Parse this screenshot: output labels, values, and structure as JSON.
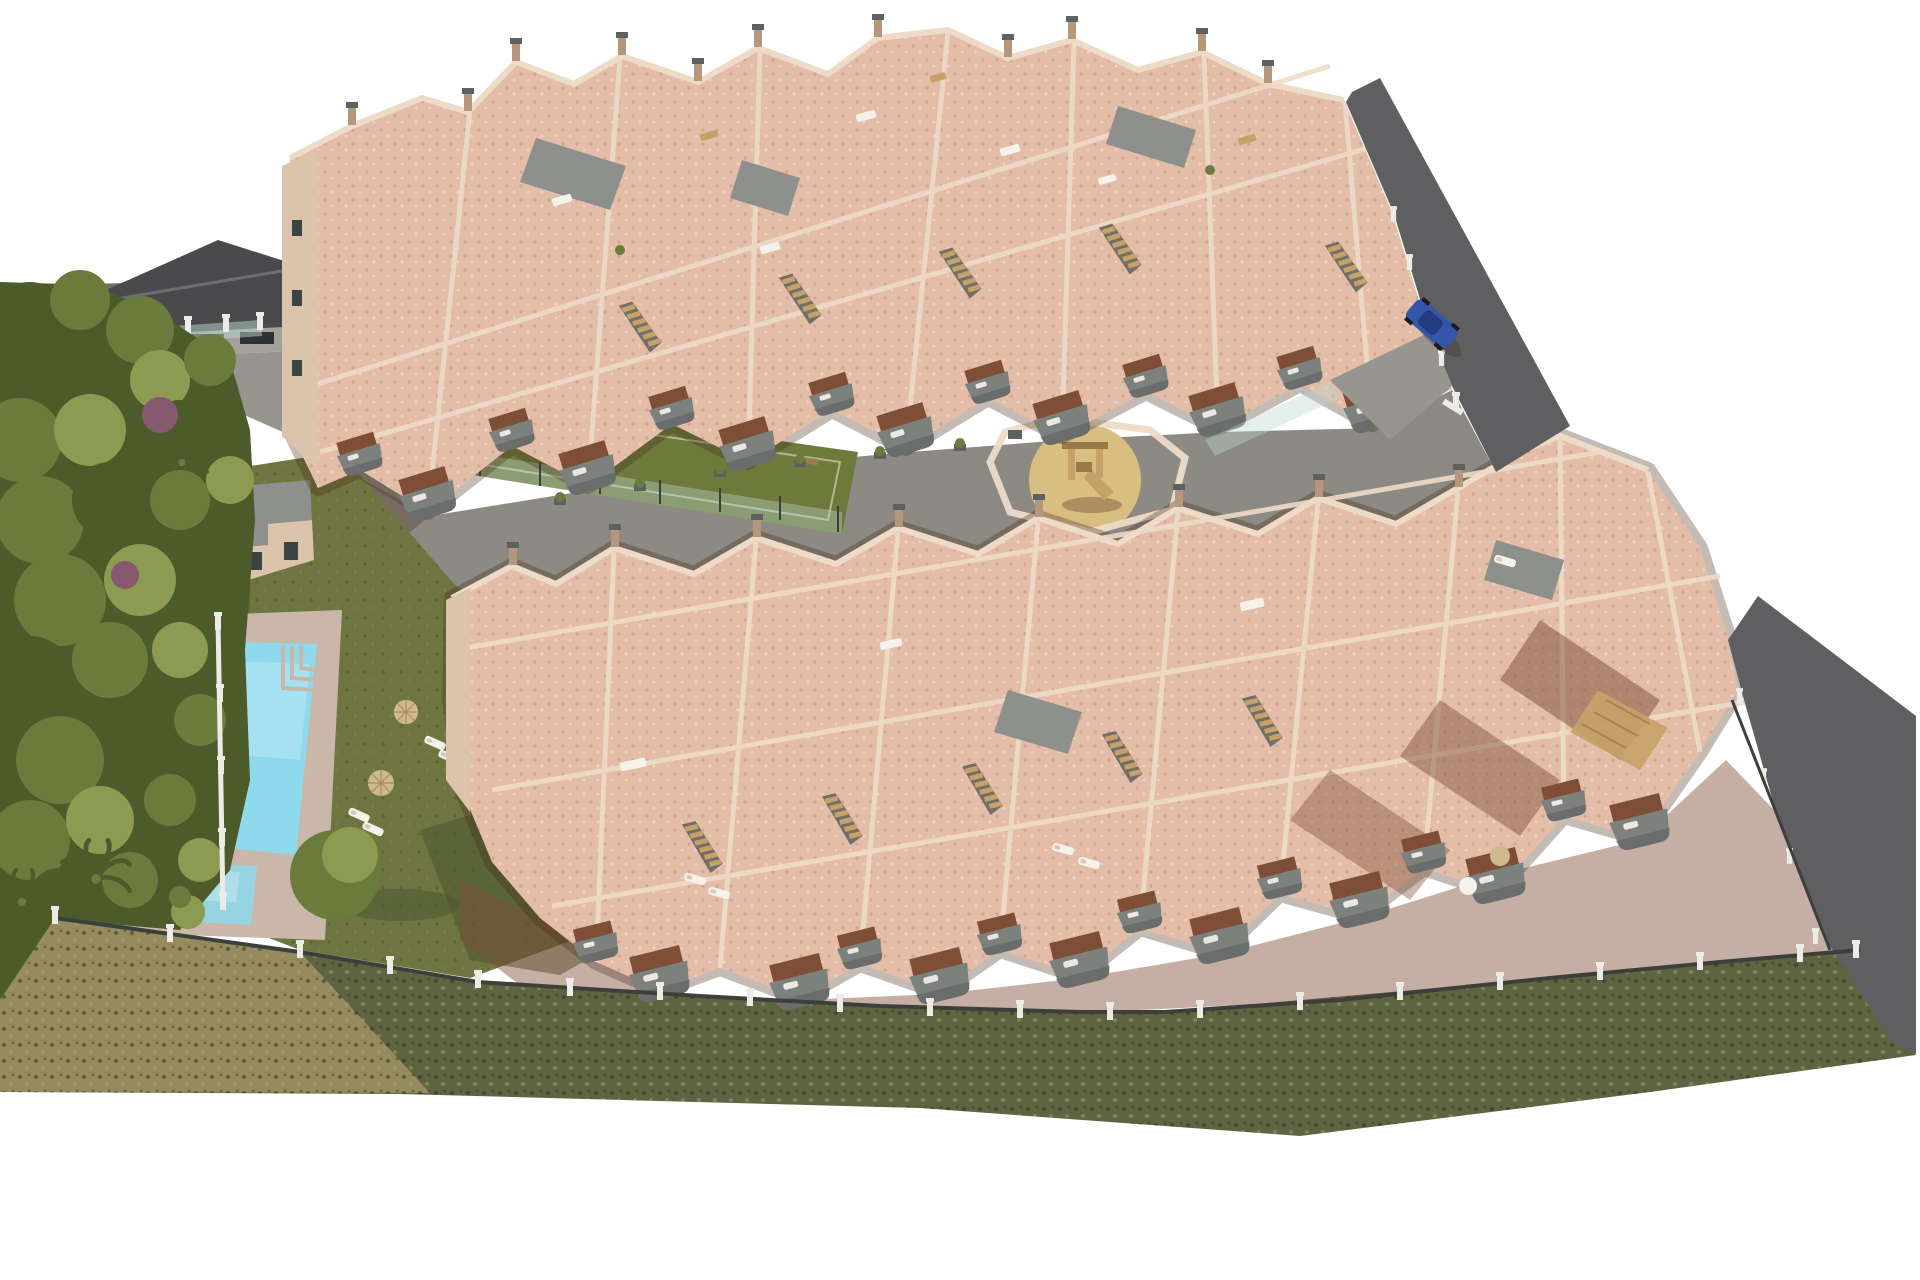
{
  "meta": {
    "title": "Aerial 3D architectural rendering of a new-build apartment complex with communal pool, gardens, playground and sports pitch",
    "image_kind": "computer-generated real-estate visualization",
    "view": "high oblique aerial view on white background"
  },
  "palette": {
    "page_bg": "#ffffff",
    "wall_light": "#eddbc7",
    "wall_mid": "#dcc3ab",
    "wall_shadow": "#b4977d",
    "terrace_tile": "#e3bda8",
    "terracotta": "#7e4e37",
    "balcony_gray": "#7d817e",
    "balcony_dark": "#5d615f",
    "panel_gray": "#8e908d",
    "road_dark": "#5f5f61",
    "paving_gray": "#98958f",
    "plaza_gray": "#8d8a84",
    "lawn_green": "#6f7540",
    "lawn_dark": "#4a552f",
    "pitch_green": "#6e7a3b",
    "tree_green": "#6b7b3c",
    "tree_dark": "#4b5b2a",
    "tree_light": "#8c9a52",
    "shrub_purple": "#86596f",
    "scrub_olive": "#5e6442",
    "scrub_tan": "#a99868",
    "pool_water": "#8ed9ec",
    "pool_light": "#c7eef7",
    "pool_deck": "#c9b7a9",
    "sand_yellow": "#d9be82",
    "wood": "#c7a268",
    "wood_dark": "#9a7a4a",
    "car_blue": "#3456aa",
    "car_dark": "#22387a",
    "fence_white": "#edebe5",
    "fence_dark": "#3c403b",
    "glass_teal": "#bcd8cf",
    "white_obj": "#f5f2eb",
    "parasol_straw": "#cdb98c",
    "neighbor_roof": "#4a4a4c",
    "neighbor_wall": "#a3a09a",
    "shadow_tint": "rgba(70,45,25,0.32)"
  },
  "scene": {
    "site": "irregular pentagonal parcel seen from above, surrounded by white emptiness",
    "buildings": {
      "upper_row": "long diagonal row of cream apartment blocks with pink tiled roof terraces, chimneys, gray solar panels, outdoor stairs and gray-fronted balconies facing lower-left",
      "lower_row": "second larger diagonal row of the same apartment type with stepped roof terraces, pergola, loungers and balconies facing the lower fence",
      "pool_house": "small cream outbuilding with flat gray roof beside the lawn",
      "neighbor_building": "adjacent existing building with dark pitched roof at top-left"
    },
    "amenities": {
      "main_pool": "rectangular turquoise pool with corner steps and ladder on a pale deck",
      "kids_pool": "small rectangular splash pool below the main pool",
      "sun_loungers_poolside": 4,
      "straw_parasols_poolside": 2,
      "lawn": "large olive-green communal lawn around the pool",
      "sports_pitch": "green multi-sport pitch with glass fence, white goal and bench between the building rows",
      "playground": "round sand area with wooden climbing frame and slide inside low cream walls"
    },
    "landscape": {
      "tree_band": "dense green tree canopy along the whole left edge with purple flowering shrubs",
      "palm_trees": 3,
      "round_clipped_tree": "layered round tree beside the kids pool",
      "scrub_strip": "dry olive-brown scrubland strip along the bottom boundary",
      "perimeter_fence": "white-posted fence with dark mesh panels along the lower boundary"
    },
    "circulation": {
      "access_road_upper": "dark asphalt road running along the upper-right edge of the complex",
      "access_road_right": "dark asphalt road wrapping down the right edge",
      "driveway_top_left": "gray paved driveway past the neighboring building",
      "central_plaza": "gray paved pedestrian spine between the two building rows"
    },
    "vehicles": {
      "parked_car": {
        "count": 1,
        "color": "blue",
        "location": "on the upper access road"
      }
    }
  }
}
